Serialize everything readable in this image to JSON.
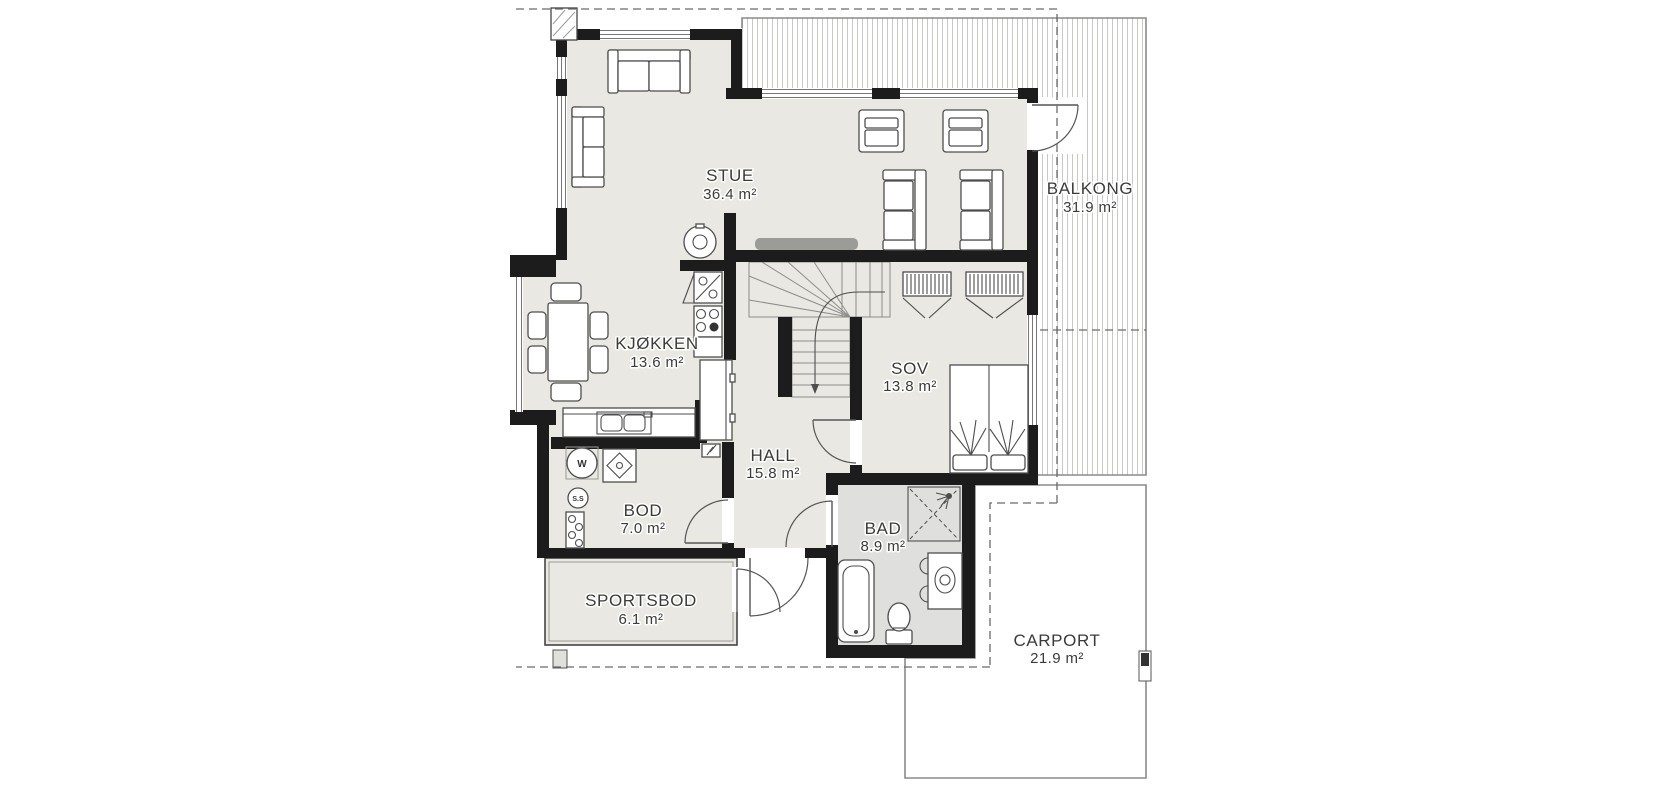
{
  "rooms": [
    {
      "id": "stue",
      "name": "STUE",
      "area": "36.4 m²"
    },
    {
      "id": "kjokken",
      "name": "KJØKKEN",
      "area": "13.6 m²"
    },
    {
      "id": "hall",
      "name": "HALL",
      "area": "15.8 m²"
    },
    {
      "id": "sov",
      "name": "SOV",
      "area": "13.8 m²"
    },
    {
      "id": "bod",
      "name": "BOD",
      "area": "7.0 m²"
    },
    {
      "id": "bad",
      "name": "BAD",
      "area": "8.9 m²"
    },
    {
      "id": "sportsbod",
      "name": "SPORTSBOD",
      "area": "6.1 m²"
    },
    {
      "id": "balkong",
      "name": "BALKONG",
      "area": "31.9 m²"
    },
    {
      "id": "carport",
      "name": "CARPORT",
      "area": "21.9 m²"
    }
  ],
  "appliances": {
    "washer_label": "W",
    "water_heater_label": "S.S"
  },
  "colors": {
    "wall": "#1c1c1c",
    "floor": "#e9e8e2",
    "floor_bad": "#dfe0dd",
    "hatch": "#c9c9c3",
    "outline": "#8a8a8a",
    "furn": "#4d4d4d",
    "label": "#3b3b39",
    "dash": "#6a6a6a",
    "sideboard": "#9b9b97"
  }
}
